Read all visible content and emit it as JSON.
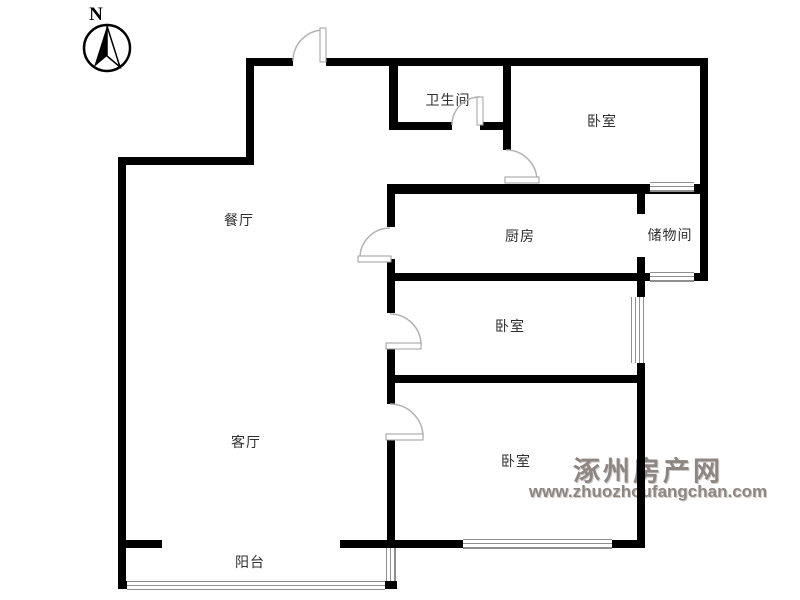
{
  "compass": {
    "label": "N"
  },
  "rooms": [
    {
      "id": "bathroom",
      "label": "卫生间"
    },
    {
      "id": "bedroom-top",
      "label": "卧室"
    },
    {
      "id": "dining-room",
      "label": "餐厅"
    },
    {
      "id": "kitchen",
      "label": "厨房"
    },
    {
      "id": "storage-room",
      "label": "储物间"
    },
    {
      "id": "bedroom-middle",
      "label": "卧室"
    },
    {
      "id": "living-room",
      "label": "客厅"
    },
    {
      "id": "bedroom-bottom",
      "label": "卧室"
    },
    {
      "id": "balcony",
      "label": "阳台"
    }
  ],
  "watermark": {
    "site_name": "涿州房产网",
    "site_url": "www.zhuozhoufangchan.com",
    "color": "#8e8682"
  },
  "colors": {
    "wall": "#000000",
    "door_line": "#b3b3b3",
    "window_line": "#8f8f8f",
    "label_text": "#2f2f2f"
  }
}
